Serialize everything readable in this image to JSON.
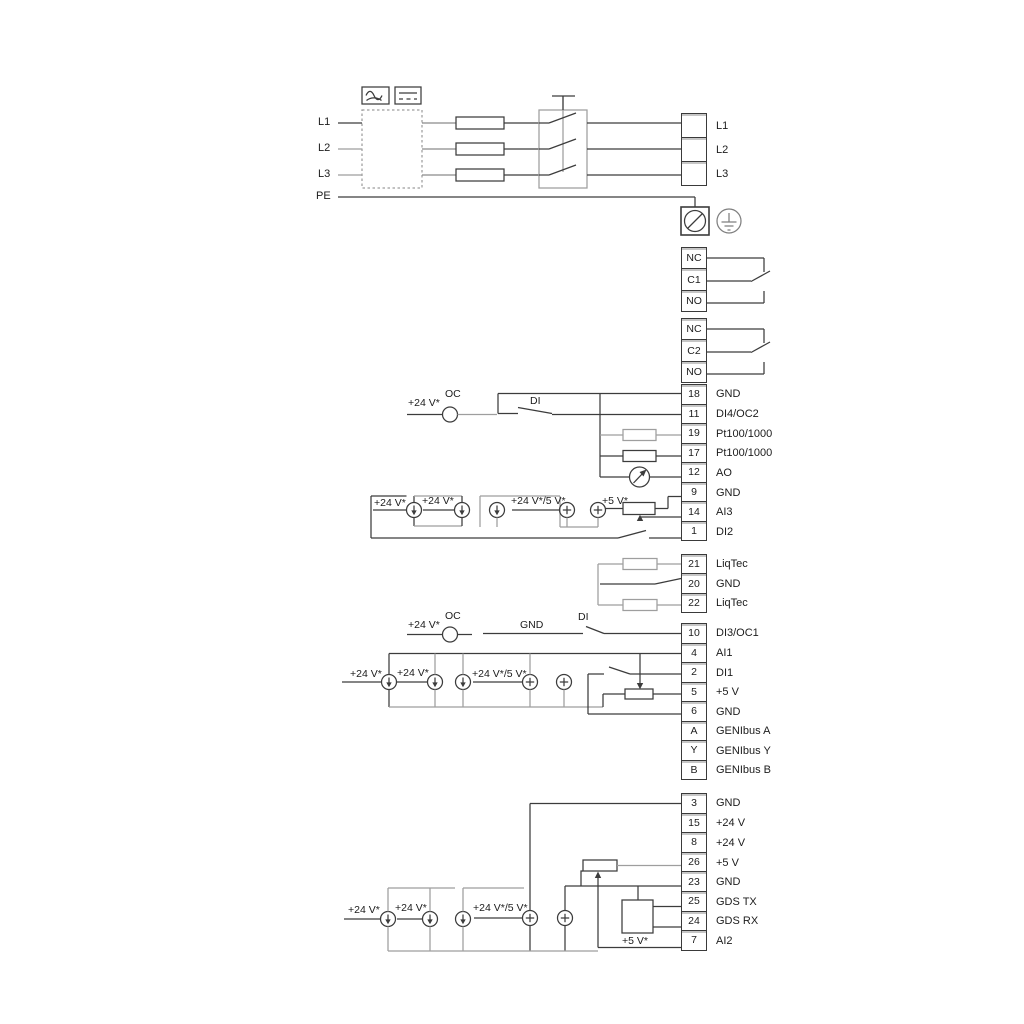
{
  "labels": {
    "mains_in": [
      "L1",
      "L2",
      "L3",
      "PE"
    ],
    "mains_out": [
      "L1",
      "L2",
      "L3"
    ],
    "relay1": [
      "NC",
      "C1",
      "NO"
    ],
    "relay2": [
      "NC",
      "C2",
      "NO"
    ],
    "supply_24": "+24 V*",
    "supply_24_5": "+24 V*/5 V*",
    "supply_5": "+5 V*",
    "oc": "OC",
    "di": "DI",
    "gnd": "GND"
  },
  "terminal_groups": {
    "io_top": [
      {
        "num": "18",
        "label": "GND"
      },
      {
        "num": "11",
        "label": "DI4/OC2"
      },
      {
        "num": "19",
        "label": "Pt100/1000"
      },
      {
        "num": "17",
        "label": "Pt100/1000"
      },
      {
        "num": "12",
        "label": "AO"
      },
      {
        "num": "9",
        "label": "GND"
      },
      {
        "num": "14",
        "label": "AI3"
      },
      {
        "num": "1",
        "label": "DI2"
      }
    ],
    "liqtec": [
      {
        "num": "21",
        "label": "LiqTec"
      },
      {
        "num": "20",
        "label": "GND"
      },
      {
        "num": "22",
        "label": "LiqTec"
      }
    ],
    "io_mid": [
      {
        "num": "10",
        "label": "DI3/OC1"
      },
      {
        "num": "4",
        "label": "AI1"
      },
      {
        "num": "2",
        "label": "DI1"
      },
      {
        "num": "5",
        "label": "+5 V"
      },
      {
        "num": "6",
        "label": "GND"
      },
      {
        "num": "A",
        "label": "GENIbus A"
      },
      {
        "num": "Y",
        "label": "GENIbus Y"
      },
      {
        "num": "B",
        "label": "GENIbus B"
      }
    ],
    "power": [
      {
        "num": "3",
        "label": "GND"
      },
      {
        "num": "15",
        "label": "+24 V"
      },
      {
        "num": "8",
        "label": "+24 V"
      },
      {
        "num": "26",
        "label": "+5 V"
      },
      {
        "num": "23",
        "label": "GND"
      },
      {
        "num": "25",
        "label": "GDS TX"
      },
      {
        "num": "24",
        "label": "GDS RX"
      },
      {
        "num": "7",
        "label": "AI2"
      }
    ]
  },
  "colors": {
    "wire": "#3c3c3c",
    "rail": "#9e9e9e",
    "text": "#1c1c1c"
  }
}
